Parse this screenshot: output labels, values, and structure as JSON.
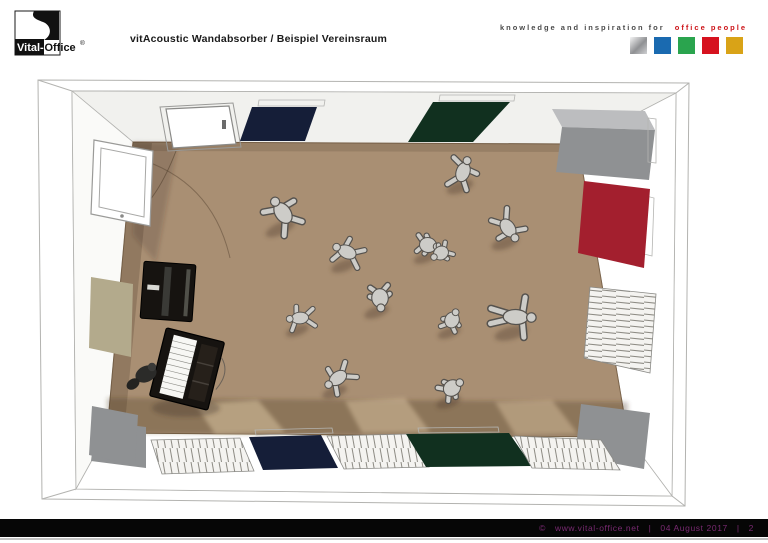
{
  "header": {
    "title": "vitAcoustic Wandabsorber / Beispiel Vereinsraum",
    "logo": {
      "brand_left": "Vital-",
      "brand_right": "Office",
      "registered_mark": "®"
    },
    "tagline": {
      "prefix": "knowledge and inspiration for",
      "highlight": "office people",
      "prefix_color": "#4a4a4a",
      "highlight_color": "#cc1318"
    },
    "brand_squares": [
      {
        "name": "silver",
        "color": "#c6c7c9"
      },
      {
        "name": "blue",
        "color": "#1a6ab0"
      },
      {
        "name": "green",
        "color": "#2aa44e"
      },
      {
        "name": "red",
        "color": "#d6121f"
      },
      {
        "name": "gold",
        "color": "#d9a317"
      }
    ]
  },
  "footer": {
    "copyright": "©",
    "url": "www.vital-office.net",
    "separator": "|",
    "date": "04 August 2017",
    "page_number": "2",
    "text_color": "#7a2a72",
    "bar_color": "#060606"
  },
  "scene": {
    "description": "Top-down 3D rendering of a Vereinsraum (club room) fitted with vitAcoustic wall absorber panels; eleven sketchy figures dance on a brown carpet, an upright piano, open keyboard piano and pianist stand at the left wall; door and window at the top-left corner",
    "colors": {
      "floor": "#a98f73",
      "floor_shadow": "#7c654c",
      "floor_light": "#d8c09c",
      "wall": "#ffffff",
      "wall_shade": "#f1f1ee",
      "wall_side": "#fafaf8",
      "outline": "#b3b3b0",
      "panel_navy": "#151e38",
      "panel_green": "#11301f",
      "panel_red": "#a31f2e",
      "panel_gray": "#8f9193",
      "panel_gray_light": "#bcbdbf",
      "panel_beige": "#b3aa8c",
      "slat_fill": "#f4f3f0",
      "slat_line": "#8d8b84",
      "figure_fill": "#cdccc8",
      "figure_outline": "#55524e",
      "piano_black": "#161310",
      "piano_keys": "#f7f7f4"
    }
  }
}
